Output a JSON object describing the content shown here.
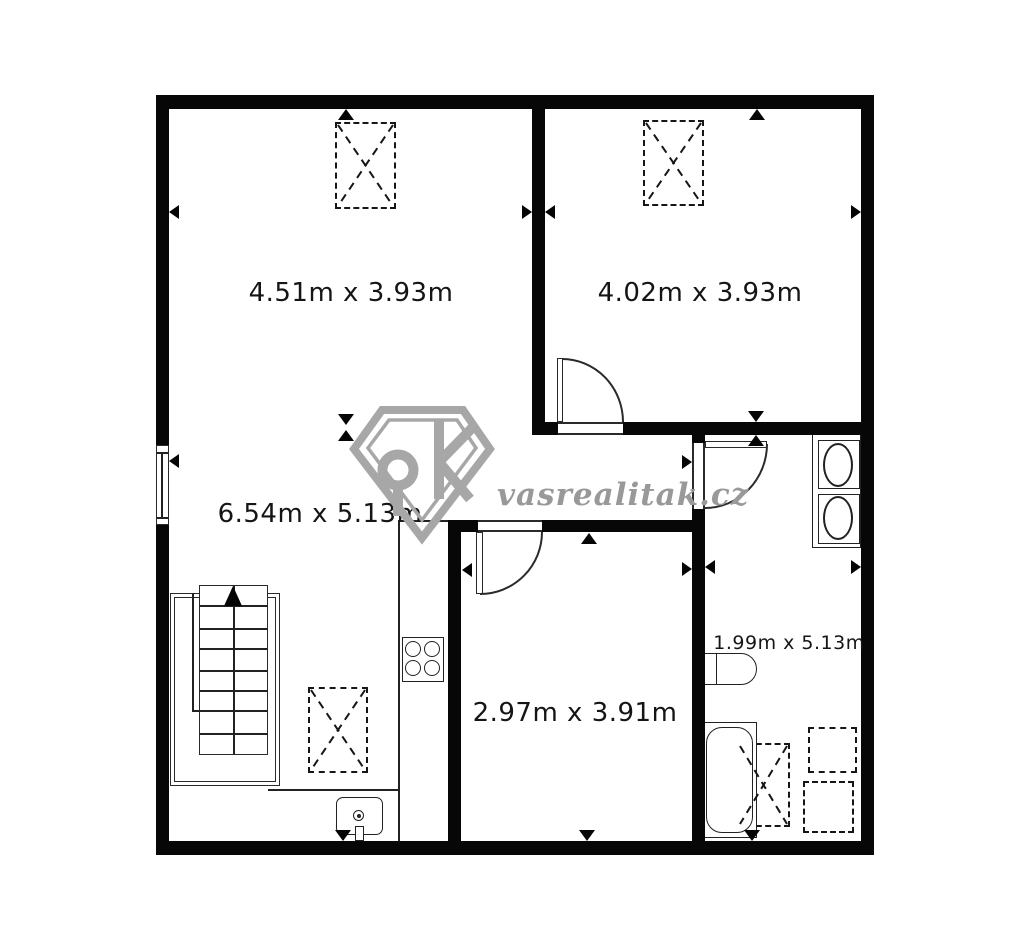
{
  "title": "apartment floor plan",
  "watermark": {
    "brand": "vasrealitak.cz"
  },
  "rooms": [
    {
      "name": "room-top-left",
      "label": "4.51m x 3.93m"
    },
    {
      "name": "room-top-right",
      "label": "4.02m x 3.93m"
    },
    {
      "name": "living-room-kitchen",
      "label": "6.54m x 5.13m"
    },
    {
      "name": "room-bottom-middle",
      "label": "2.97m x 3.91m"
    },
    {
      "name": "bathroom-corridor",
      "label": "1.99m x 5.13m"
    }
  ],
  "fixtures": [
    "stairs-up",
    "kitchen-counter",
    "stove-4-burners",
    "kitchen-sink",
    "window",
    "door-swing",
    "wardrobe-dashed-box",
    "washing-area-dashed-box",
    "double-washbasin",
    "toilet",
    "bathtub",
    "measure-arrow"
  ],
  "colors": {
    "wall": "#070707",
    "line": "#222222",
    "watermark": "#a7a7a7",
    "label": "#151515",
    "background": "#ffffff"
  }
}
